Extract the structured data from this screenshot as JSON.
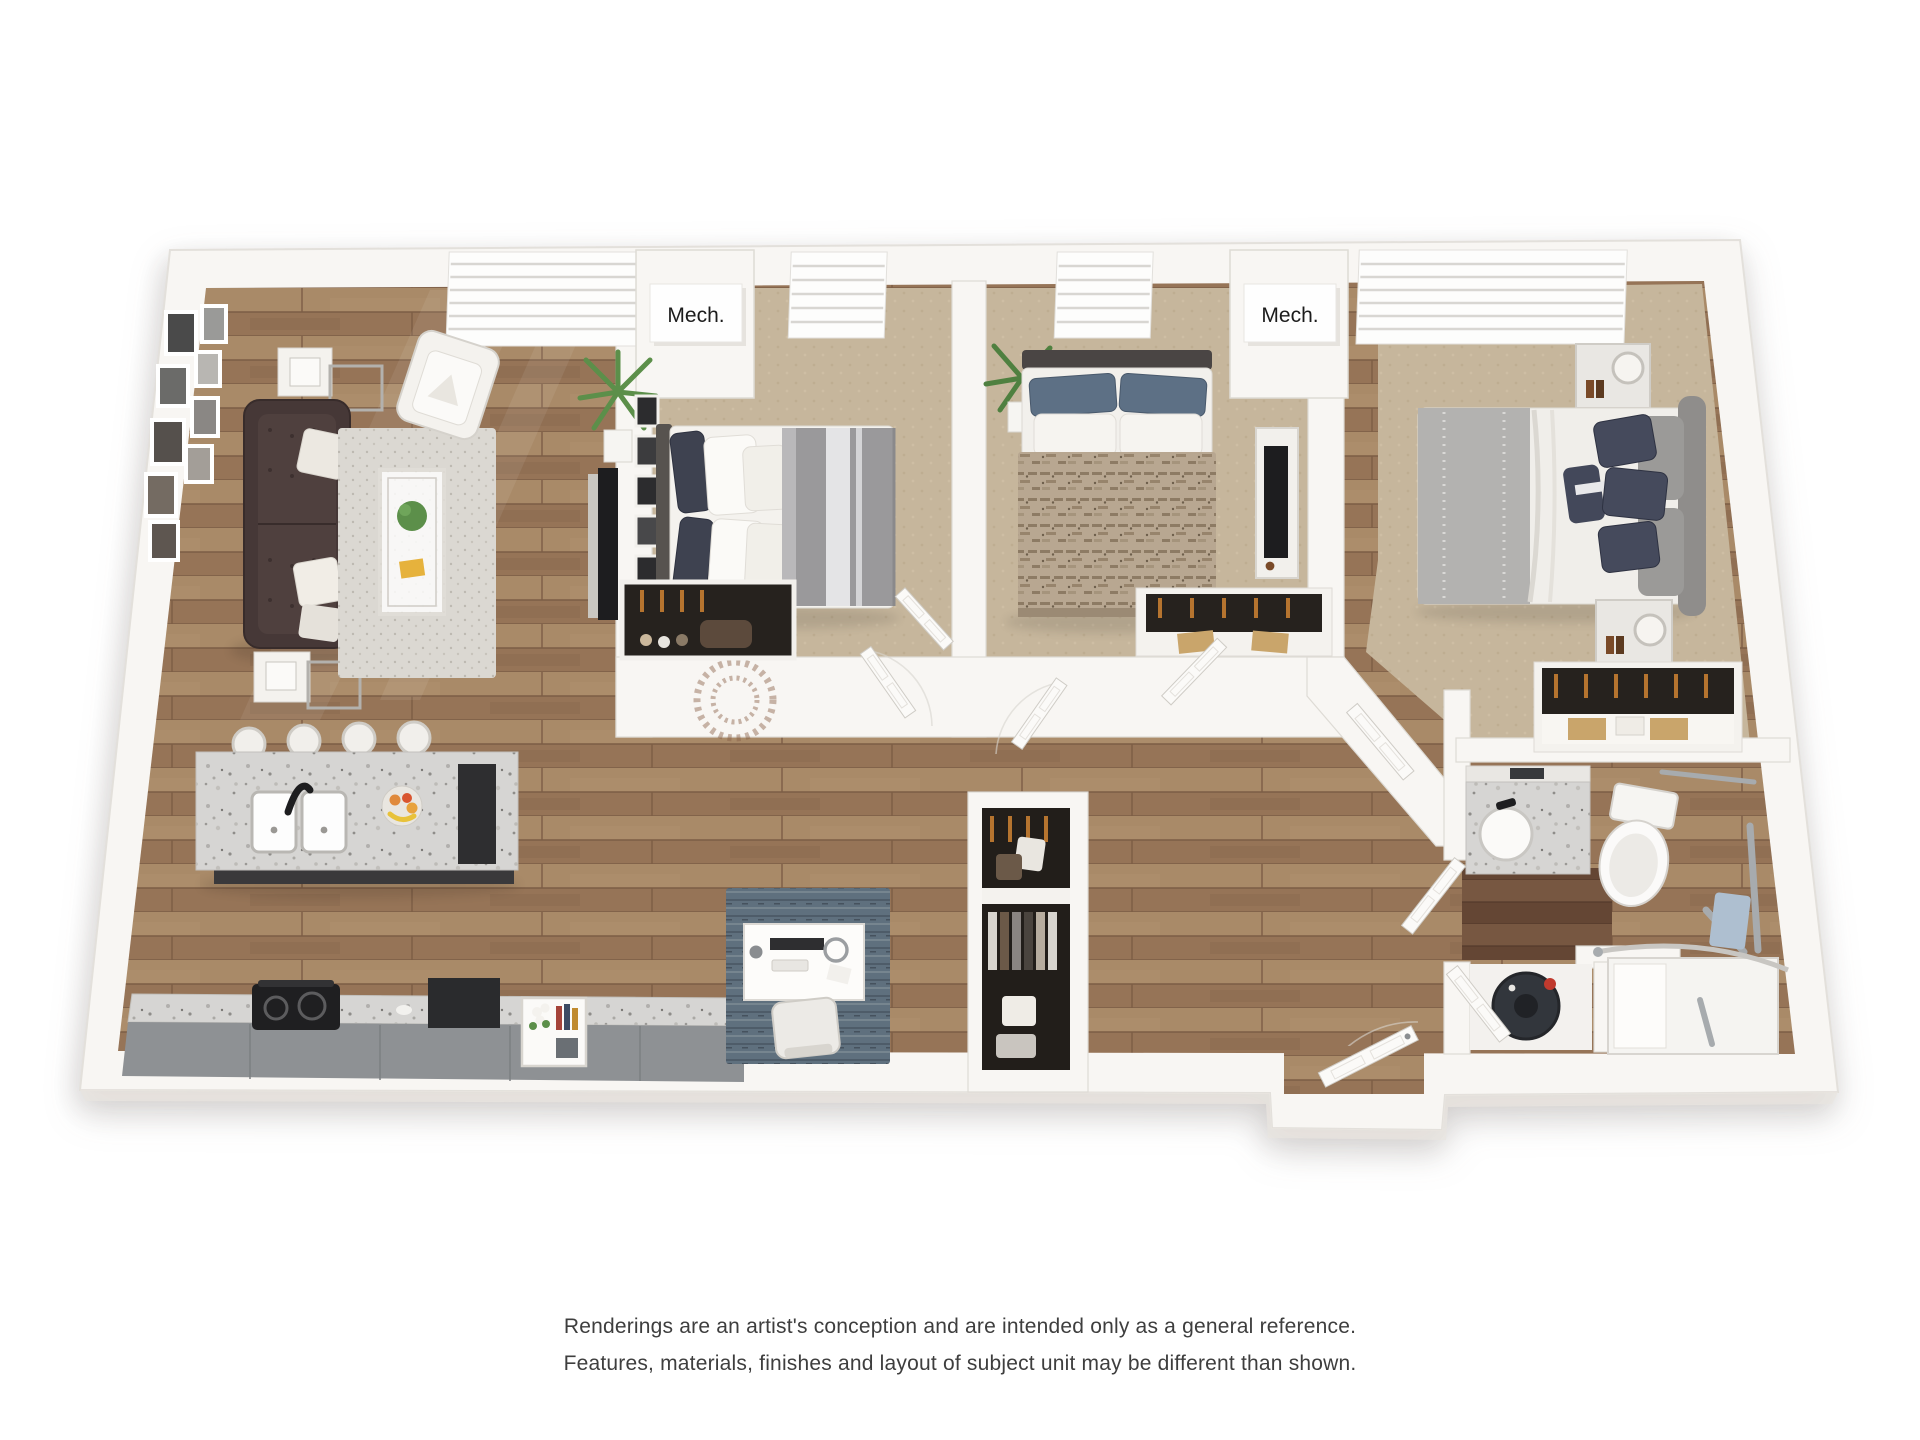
{
  "scene": {
    "type": "3d-floor-plan-rendering",
    "background": "#ffffff"
  },
  "labels": {
    "mech_1": "Mech.",
    "mech_2": "Mech."
  },
  "disclaimer": {
    "line1": "Renderings are an artist's conception and are intended only as a general reference.",
    "line2": "Features, materials, finishes and layout of subject unit may be different than shown."
  },
  "palette": {
    "wall": "#f8f6f3",
    "wall_edge": "#dedbd5",
    "wall_shade": "#eceae6",
    "wood_floor": "#a0805f",
    "wood_floor_dark": "#8a6a50",
    "carpet": "#c6b69c",
    "bath_floor": "#6e4f3c",
    "granite": "#d6d5d3",
    "cabinet_dark": "#37373a",
    "counter_front": "#8e9194",
    "sofa": "#463837",
    "rug_living": "#dbd8d2",
    "rug_desk": "#5f707e",
    "bed_gray": "#9a999b",
    "pillow_navy": "#454a5c",
    "duvet_boho": "#b8a791",
    "chrome": "#a7abae",
    "plant_green": "#5c8f4a",
    "tan_box": "#c9a56b",
    "door": "#fbfaf8",
    "label_text": "#1c1c1c",
    "disclaimer_text": "#3e3e3e"
  }
}
